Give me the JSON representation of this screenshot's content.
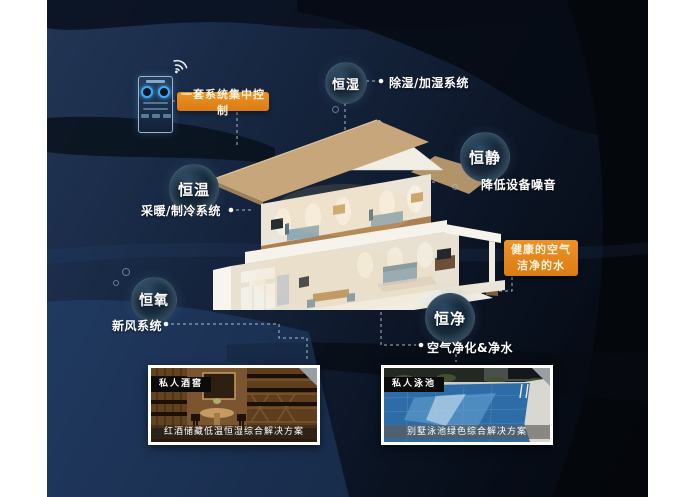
{
  "control_panel": {
    "label": "一套系统集中控制",
    "device": "smart-home-wall-panel",
    "wifi_icon": "wifi-icon"
  },
  "highlight": {
    "line1": "健康的空气",
    "line2": "洁净的水"
  },
  "features": [
    {
      "title": "恒湿",
      "description": "除湿/加湿系统"
    },
    {
      "title": "恒静",
      "description": "降低设备噪音"
    },
    {
      "title": "恒温",
      "description": "采暖/制冷系统"
    },
    {
      "title": "恒氧",
      "description": "新风系统"
    },
    {
      "title": "恒净",
      "description": "空气净化&净水"
    }
  ],
  "cards": [
    {
      "tag": "私人酒窖",
      "caption": "红酒储藏低温恒湿综合解决方案"
    },
    {
      "tag": "私人泳池",
      "caption": "别墅泳池绿色综合解决方案"
    }
  ],
  "colors": {
    "accent_orange": "#e2861d",
    "panel_navy": "#16243c",
    "bubble_rim": "#9cc4dd",
    "text_white": "#ffffff"
  }
}
